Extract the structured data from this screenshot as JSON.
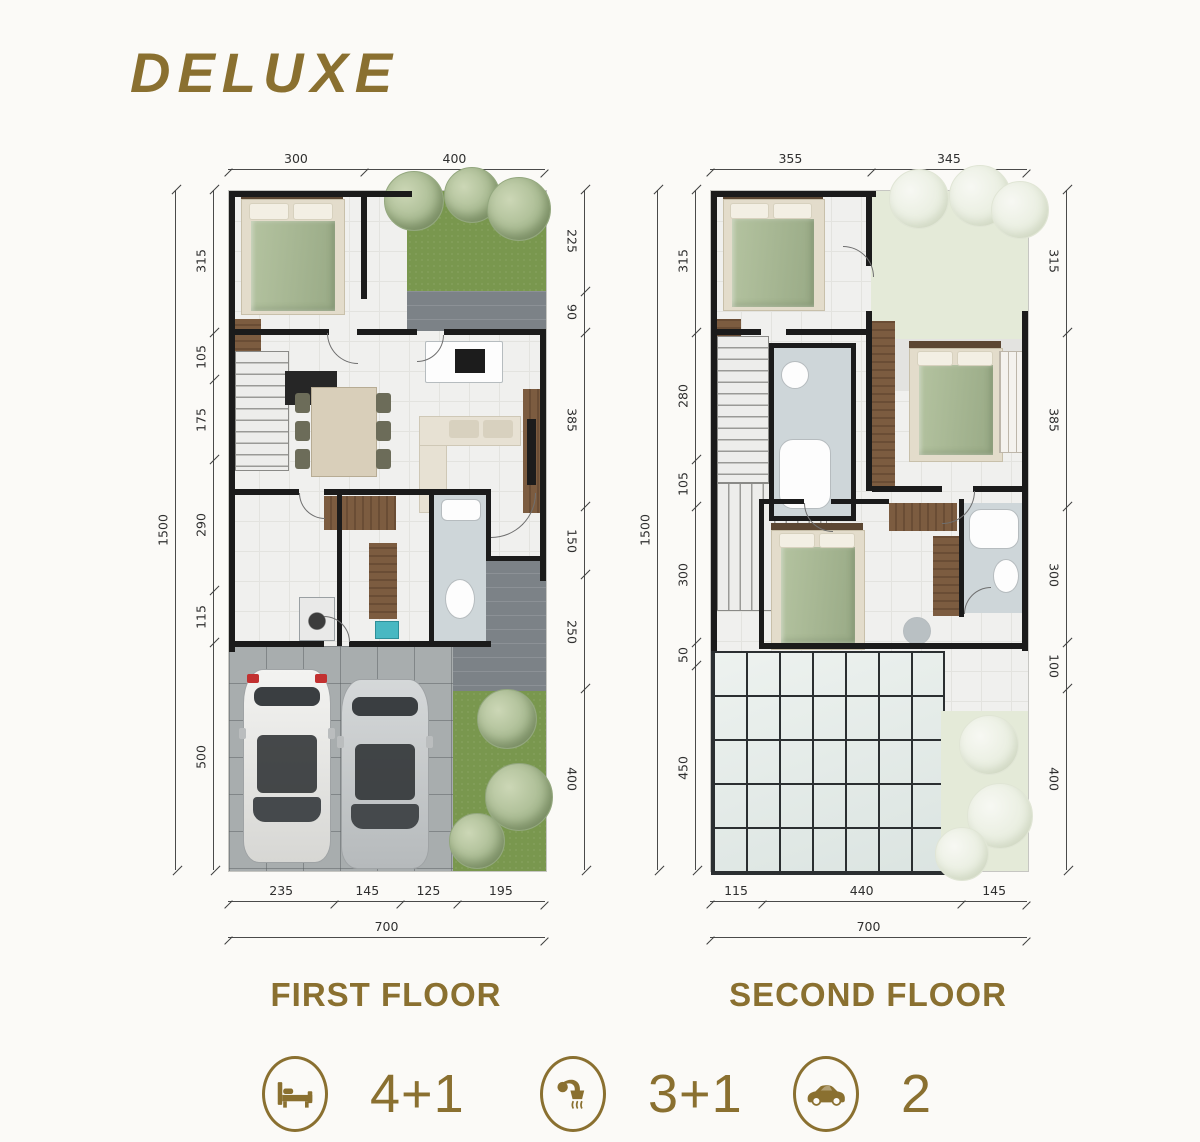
{
  "title": "DELUXE",
  "colors": {
    "accent": "#8a7030"
  },
  "plans": [
    {
      "label": "FIRST FLOOR",
      "dims": {
        "top": [
          "300",
          "400"
        ],
        "left": [
          "315",
          "105",
          "175",
          "290",
          "115",
          "500"
        ],
        "left_total": "1500",
        "right": [
          "225",
          "90",
          "385",
          "150",
          "250",
          "400"
        ],
        "bottom": [
          "235",
          "145",
          "125",
          "195"
        ],
        "bottom_total": "700"
      }
    },
    {
      "label": "SECOND FLOOR",
      "dims": {
        "top": [
          "355",
          "345"
        ],
        "left": [
          "315",
          "280",
          "105",
          "300",
          "50",
          "450"
        ],
        "left_total": "1500",
        "right": [
          "315",
          "385",
          "300",
          "100",
          "400"
        ],
        "bottom": [
          "115",
          "440",
          "145"
        ],
        "bottom_total": "700"
      }
    }
  ],
  "stats": [
    {
      "icon": "bed-icon",
      "value": "4+1"
    },
    {
      "icon": "shower-icon",
      "value": "3+1"
    },
    {
      "icon": "car-icon",
      "value": "2"
    }
  ]
}
